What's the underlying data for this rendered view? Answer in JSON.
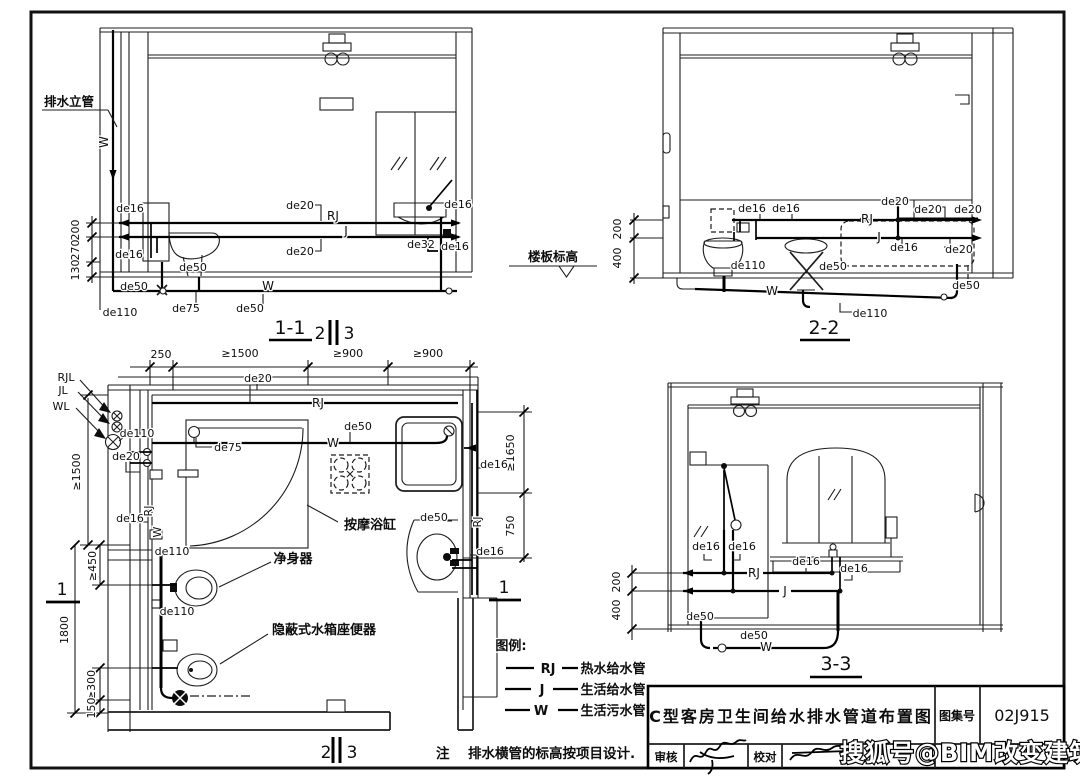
{
  "sheet": {
    "paper_color": "#ffffff",
    "ink_color": "#111111"
  },
  "codes": {
    "de16": "de16",
    "de20": "de20",
    "de32": "de32",
    "de50": "de50",
    "de75": "de75",
    "de110": "de110",
    "RJ": "RJ",
    "J": "J",
    "W": "W",
    "RJL": "RJL",
    "JL": "JL",
    "WL": "WL"
  },
  "dims": {
    "d130": "130",
    "d270": "270",
    "d200": "200",
    "d250": "250",
    "d150": "150",
    "d400": "400",
    "d750": "750",
    "d1800": "1800",
    "ge300": "≥300",
    "ge450": "≥450",
    "ge900": "≥900",
    "ge1500": "≥1500",
    "ge1650": "≥1650"
  },
  "views": {
    "s11": "1-1",
    "s22": "2-2",
    "s33": "3-3",
    "cut1": "1",
    "cut2": "2",
    "cut3": "3"
  },
  "annotations": {
    "drain_riser": "排水立管",
    "floor_level": "楼板标高",
    "massage_tub": "按摩浴缸",
    "bidet": "净身器",
    "concealed_toilet": "隐蔽式水箱座便器"
  },
  "legend": {
    "title": "图例:",
    "items": [
      {
        "code": "RJ",
        "label": "热水给水管"
      },
      {
        "code": "J",
        "label": "生活给水管"
      },
      {
        "code": "W",
        "label": "生活污水管"
      }
    ]
  },
  "note": {
    "prefix": "注",
    "text": "排水横管的标高按项目设计."
  },
  "titleblock": {
    "drawing_title": "C型客房卫生间给水排水管道布置图",
    "atlas_label": "图集号",
    "atlas_no": "02J915",
    "review_label": "审核",
    "proof_label": "校对"
  },
  "watermark": {
    "text": "搜狐号@BIM改变建筑"
  }
}
